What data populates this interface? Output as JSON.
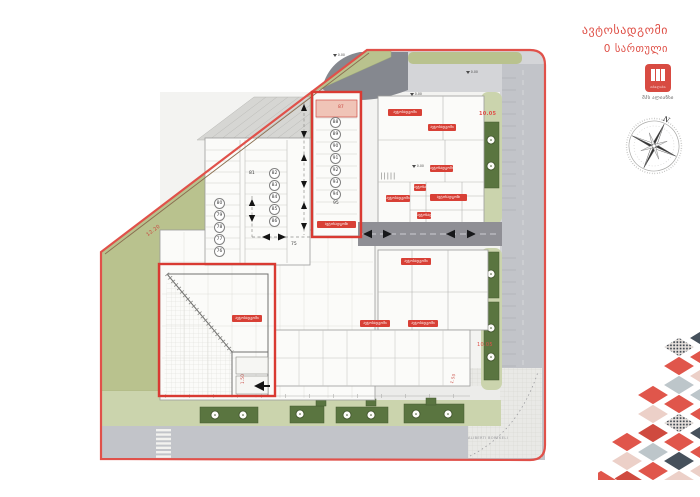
{
  "sheet": {
    "title_line1": "ავტოსადგომი",
    "title_line2": "0 სართული"
  },
  "logo": {
    "inner_text": "თბილისი",
    "caption": "შპს ალიანსი"
  },
  "compass": {
    "north": "N"
  },
  "plan": {
    "label_text": "ავტოსადგომი",
    "street_label": "ALIBERTI BORTKELI",
    "level_mark": "0.00",
    "dims": {
      "left_diag": "12.20",
      "right_top": "10.05",
      "right_mid": "10.05",
      "bottom_a": "1.50",
      "bottom_b": "1.50"
    },
    "stalls": {
      "pink": "87",
      "top": [
        "88",
        "89",
        "90",
        "91",
        "92",
        "93",
        "94"
      ],
      "top_last": "95",
      "left": [
        "80",
        "79",
        "78",
        "77",
        "76"
      ],
      "mid": [
        "82",
        "83",
        "84",
        "85",
        "86"
      ],
      "single_a": "81",
      "single_b": "75"
    },
    "colors": {
      "boundary": "#e0514a",
      "highlight": "#d93a32",
      "label_bg": "#d84036",
      "green": "#b9c28e",
      "road": "#c2c4c9",
      "tree_green": "#5a7540"
    }
  }
}
